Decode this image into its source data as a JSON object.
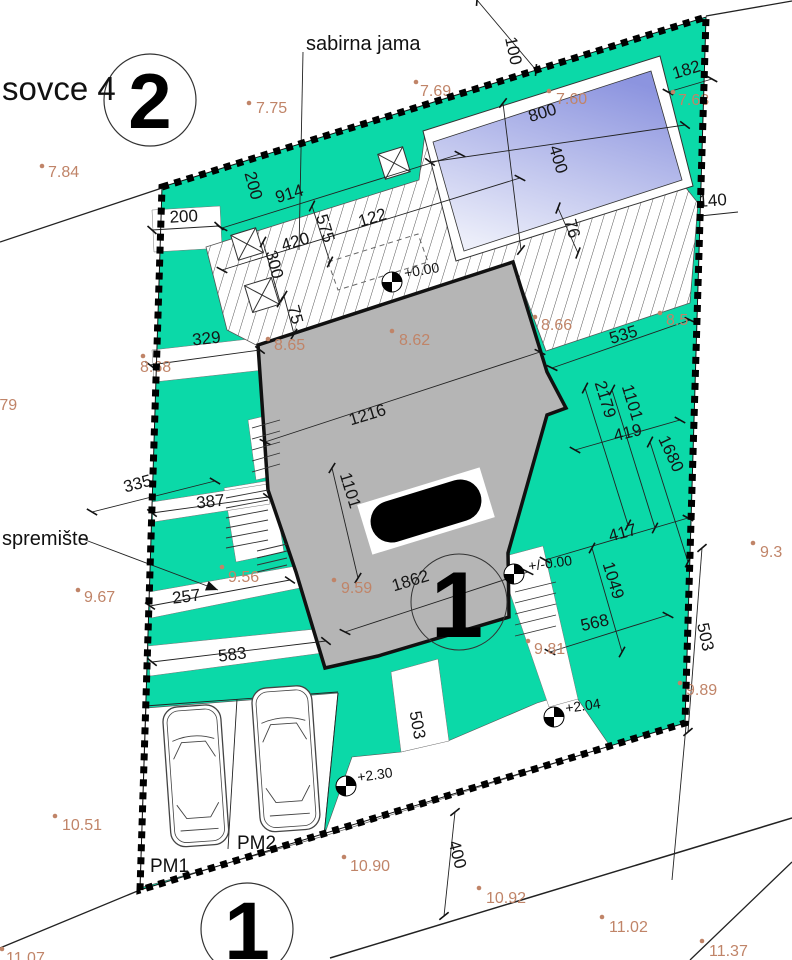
{
  "drawing": {
    "street_label": "sovce 4",
    "sabirna_jama_label": "sabirna jama",
    "spremiste_label": "spremište"
  },
  "parcels": {
    "plot_2": "2",
    "plot_1_center": "1",
    "plot_1_bottom": "1"
  },
  "parking": {
    "pm1": "PM1",
    "pm2": "PM2"
  },
  "levels": [
    {
      "label": "+0.00"
    },
    {
      "label": "+/-0.00"
    },
    {
      "label": "+2.04"
    },
    {
      "label": "+2.30"
    }
  ],
  "dims": [
    {
      "v": "200"
    },
    {
      "v": "200"
    },
    {
      "v": "914"
    },
    {
      "v": "575"
    },
    {
      "v": "420"
    },
    {
      "v": "122"
    },
    {
      "v": "300"
    },
    {
      "v": "75"
    },
    {
      "v": "329"
    },
    {
      "v": "100"
    },
    {
      "v": "800"
    },
    {
      "v": "400"
    },
    {
      "v": "76"
    },
    {
      "v": "182"
    },
    {
      "v": "140"
    },
    {
      "v": "535"
    },
    {
      "v": "2179"
    },
    {
      "v": "1101"
    },
    {
      "v": "419"
    },
    {
      "v": "1680"
    },
    {
      "v": "417"
    },
    {
      "v": "1049"
    },
    {
      "v": "568"
    },
    {
      "v": "503"
    },
    {
      "v": "1216"
    },
    {
      "v": "1101"
    },
    {
      "v": "1862"
    },
    {
      "v": "387"
    },
    {
      "v": "335"
    },
    {
      "v": "257"
    },
    {
      "v": "583"
    },
    {
      "v": "503"
    },
    {
      "v": "400"
    }
  ],
  "elevations": [
    {
      "v": "7.84"
    },
    {
      "v": "7.75"
    },
    {
      "v": "7.69"
    },
    {
      "v": "7.60"
    },
    {
      "v": "7.63"
    },
    {
      "v": "8.79"
    },
    {
      "v": "8.68"
    },
    {
      "v": "8.65"
    },
    {
      "v": "8.62"
    },
    {
      "v": "8.66"
    },
    {
      "v": "8.5"
    },
    {
      "v": "9.67"
    },
    {
      "v": "9.56"
    },
    {
      "v": "9.59"
    },
    {
      "v": "9.3"
    },
    {
      "v": "9.81"
    },
    {
      "v": "9.89"
    },
    {
      "v": "10.51"
    },
    {
      "v": "10.90"
    },
    {
      "v": "10.92"
    },
    {
      "v": "11.02"
    },
    {
      "v": "11.37"
    },
    {
      "v": "11.07"
    }
  ],
  "colors": {
    "teal": "#0BD9A8",
    "building": "#B5B5B5",
    "pool_top": "#8C94DF",
    "pool_bottom": "#EDEFFA",
    "elevation_text": "#C08468",
    "hatch_line": "#555555"
  }
}
